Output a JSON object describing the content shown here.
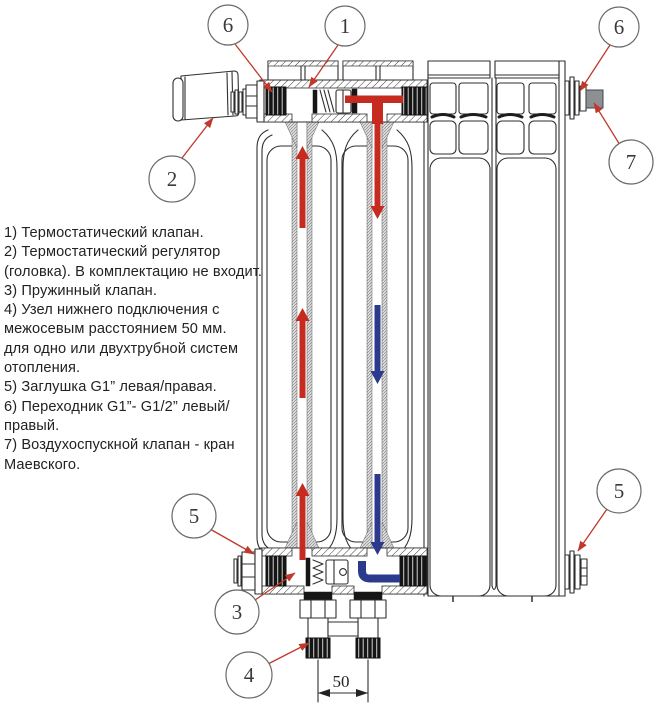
{
  "legend": {
    "lines": [
      "1) Термостатический клапан.",
      "2) Термостатический регулятор",
      "(головка). В комплектацию не входит.",
      "3) Пружинный клапан.",
      "4) Узел нижнего подключения с",
      "межосевым расстоянием 50 мм.",
      "для одно или двухтрубной систем",
      "отопления.",
      "5) Заглушка G1” левая/правая.",
      "6) Переходник G1”- G1/2” левый/",
      "правый.",
      "7) Воздухоспускной клапан - кран",
      "Маевского."
    ]
  },
  "callouts": [
    {
      "label": "6"
    },
    {
      "label": "1"
    },
    {
      "label": "2"
    },
    {
      "label": "6"
    },
    {
      "label": "7"
    },
    {
      "label": "5"
    },
    {
      "label": "3"
    },
    {
      "label": "4"
    },
    {
      "label": "5"
    }
  ],
  "dimension": {
    "value": "50"
  },
  "colors": {
    "hot": "#c72b20",
    "cold": "#2b3a8c",
    "leader": "#c0392b",
    "line": "#2f2f2f",
    "vent": "#8d9093"
  }
}
